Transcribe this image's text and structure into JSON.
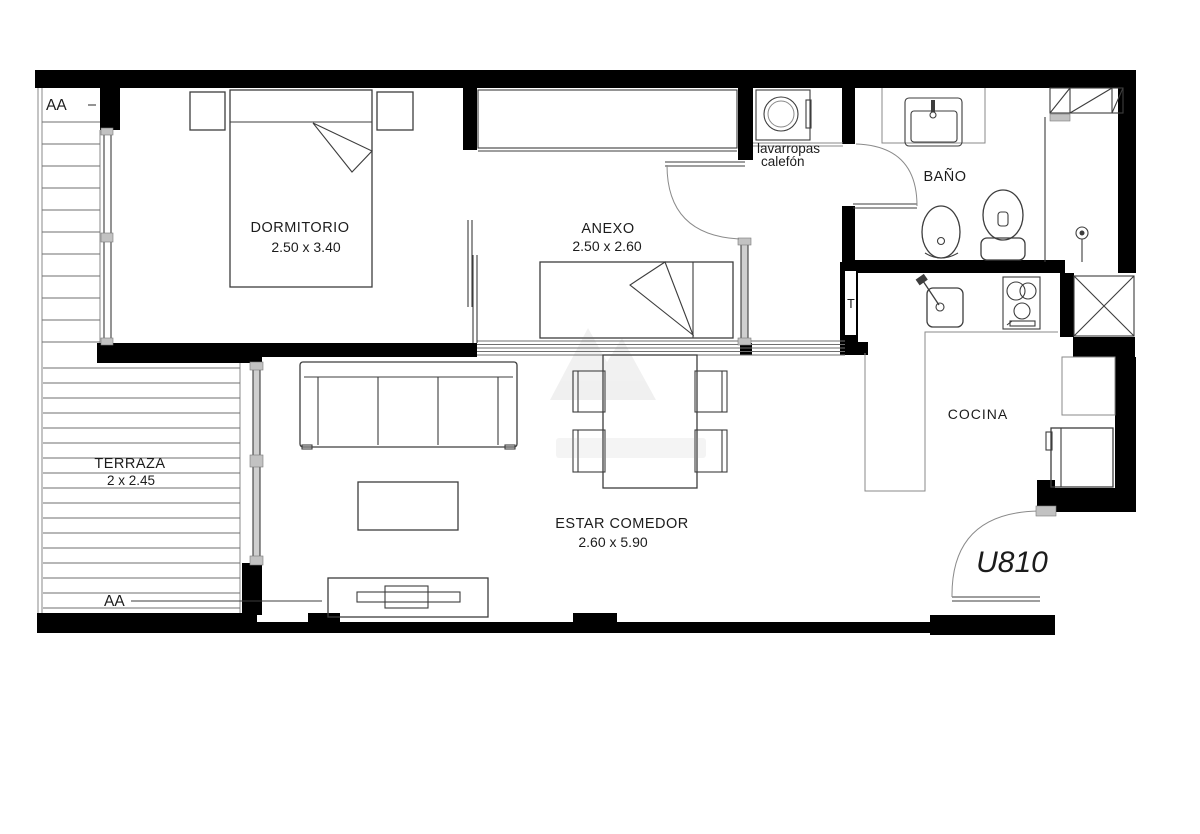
{
  "plan": {
    "rooms": [
      {
        "name": "DORMITORIO",
        "dims": "2.50 x 3.40"
      },
      {
        "name": "ANEXO",
        "dims": "2.50 x 2.60"
      },
      {
        "name": "ESTAR COMEDOR",
        "dims": "2.60 x 5.90"
      },
      {
        "name": "TERRAZA",
        "dims": "2 x 2.45"
      },
      {
        "name": "BAÑO",
        "dims": ""
      },
      {
        "name": "COCINA",
        "dims": ""
      }
    ],
    "labels": {
      "washer_line1": "lavarropas",
      "washer_line2": "calefón",
      "duct": "T",
      "section_top": "AA",
      "section_bottom": "AA",
      "unit": "U810"
    },
    "colors": {
      "wall": "#000000",
      "furniture_line": "#3d3d3d",
      "light_line": "#8a8a8a",
      "glass": "#cfcfcf",
      "text": "#1c1c1c"
    }
  }
}
